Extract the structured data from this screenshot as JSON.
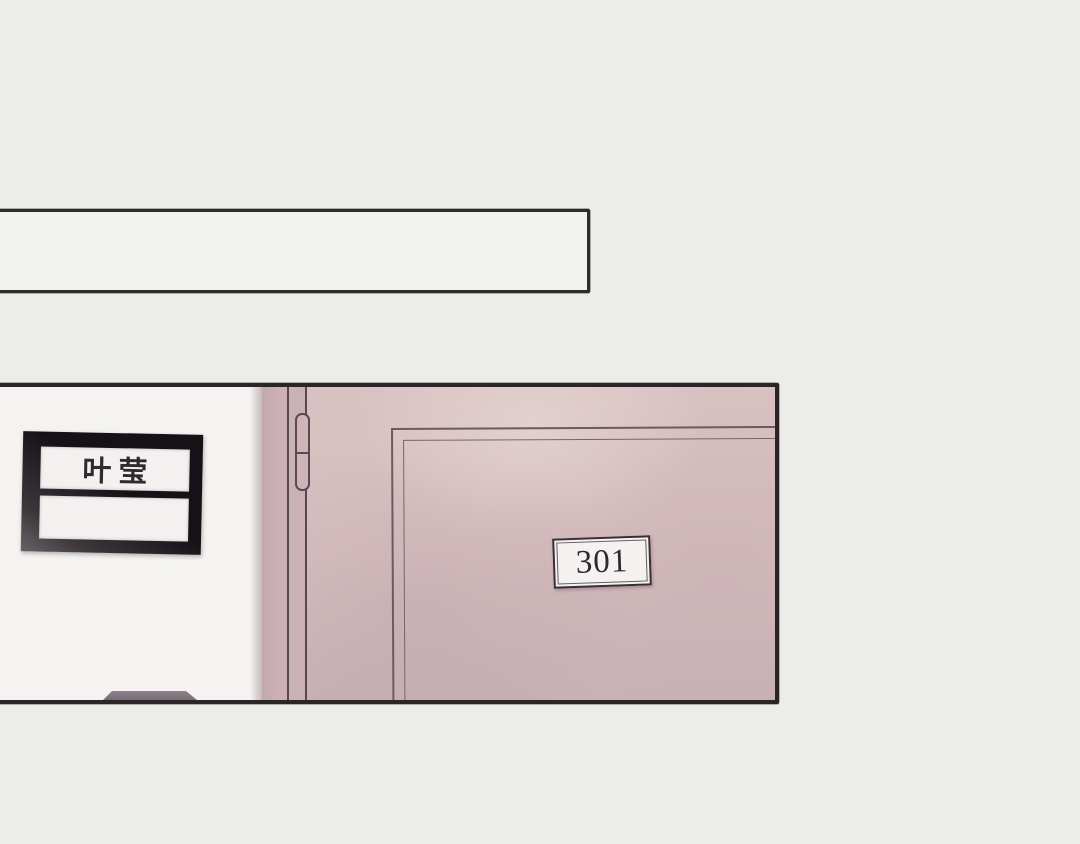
{
  "panel": {
    "kind": "comic-scene-door-hallway",
    "top_caption_bar": {
      "text": ""
    },
    "nameplate": {
      "name": "叶莹",
      "second_line": ""
    },
    "door": {
      "room_number": "301"
    },
    "colors": {
      "background": "#ececea",
      "wall_white": "#f4f3f1",
      "door_pink": "#d5bcbe",
      "door_jamb_pink": "#cbb1b5",
      "ink_dark": "#2b2528",
      "plate_frame_dark": "#141117",
      "slot_white": "#f3f1f0",
      "sign_white": "#f4f1f1"
    }
  }
}
